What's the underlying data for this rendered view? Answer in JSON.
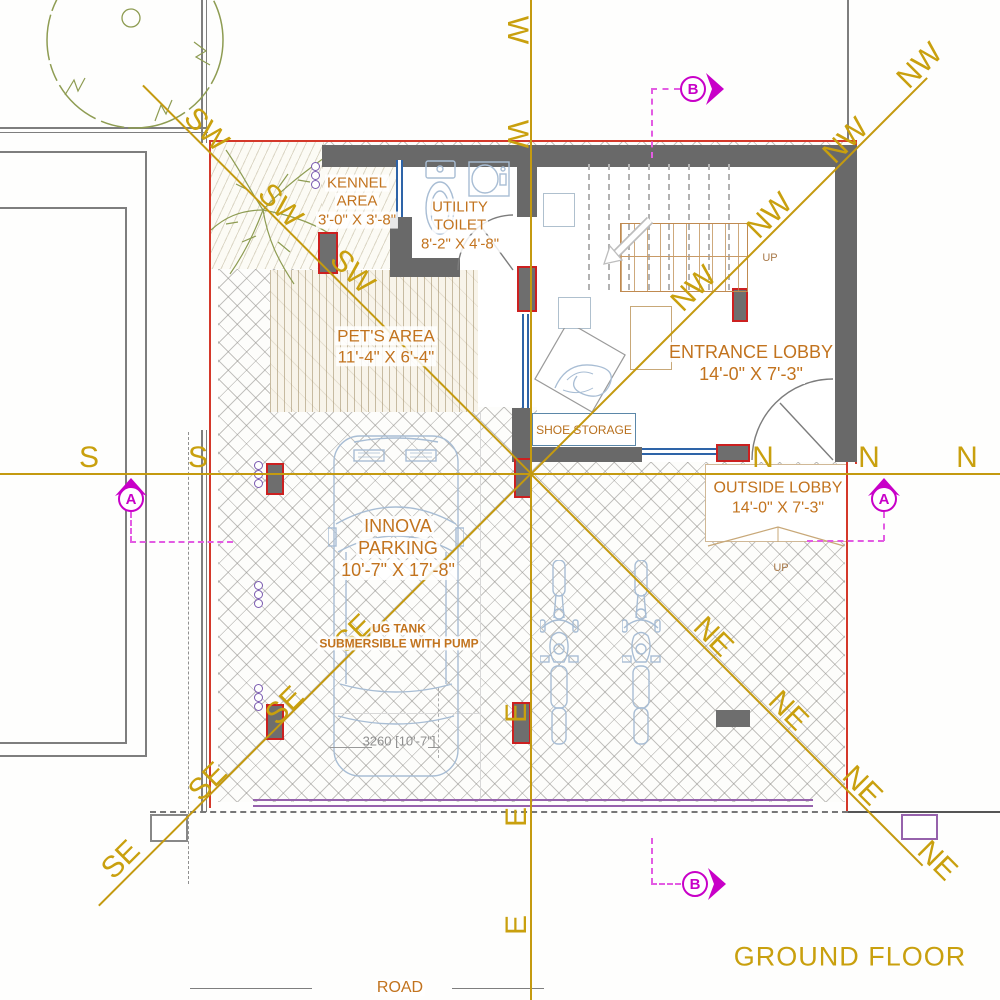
{
  "plan": {
    "floor_label": "GROUND FLOOR",
    "road_label": "ROAD"
  },
  "rooms": {
    "kennel_area": {
      "line1": "KENNEL",
      "line2": "AREA",
      "dims": "3'-0\" X 3'-8\""
    },
    "utility_toilet": {
      "line1": "UTILITY",
      "line2": "TOILET",
      "dims": "8'-2\" X 4'-8\""
    },
    "pets_area": {
      "name": "PET'S AREA",
      "dims": "11'-4\" X 6'-4\""
    },
    "entrance_lobby": {
      "name": "ENTRANCE LOBBY",
      "dims": "14'-0\" X 7'-3\""
    },
    "outside_lobby": {
      "name": "OUTSIDE LOBBY",
      "dims": "14'-0\" X 7'-3\""
    },
    "innova_parking": {
      "line1": "INNOVA",
      "line2": "PARKING",
      "dims": "10'-7\" X 17'-8\""
    },
    "shoe_storage": {
      "name": "SHOE STORAGE"
    },
    "ug_tank": {
      "line1": "UG TANK",
      "line2": "SUBMERSIBLE WITH PUMP"
    }
  },
  "annotations": {
    "stair_up": "UP",
    "lobby_up": "UP",
    "car_dimension": "3260 [10'-7\"]"
  },
  "compass": {
    "north": "N",
    "south": "S",
    "east": "E",
    "west": "W",
    "northeast": "NE",
    "northwest": "NW",
    "southeast": "SE",
    "southwest": "SW"
  },
  "section_markers": {
    "a": "A",
    "b": "B"
  },
  "colors": {
    "compass_gold": "#C9A00E",
    "label_orange": "#C2731E",
    "wall_gray": "#696969",
    "property_red": "#D4382A",
    "marker_magenta": "#C800C8",
    "window_blue": "#2E64A8",
    "vehicle_blue": "#A8BDD4",
    "tree_olive": "#8E9C52",
    "road_purple": "#9662AC"
  }
}
